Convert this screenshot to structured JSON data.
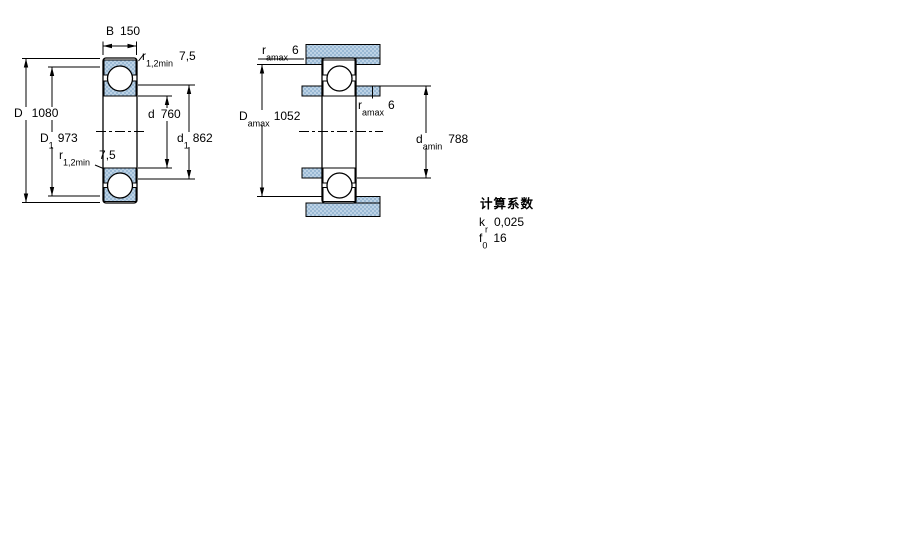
{
  "colors": {
    "hatch_light": "#bdd3e6",
    "hatch_dark": "#9ab9d4",
    "line": "#000000",
    "background": "#ffffff"
  },
  "left_drawing": {
    "width": {
      "base": "B",
      "value": "150"
    },
    "outer_diameter": {
      "base": "D",
      "value": "1080"
    },
    "outer_ring_shoulder": {
      "base": "D",
      "sub": "1",
      "value": "973"
    },
    "bore": {
      "base": "d",
      "value": "760"
    },
    "inner_ring_shoulder": {
      "base": "d",
      "sub": "1",
      "value": "862"
    },
    "fillet_top": {
      "base": "r",
      "sub": "1,2min",
      "value": "7,5"
    },
    "fillet_mid": {
      "base": "r",
      "sub": "1,2min",
      "value": "7,5"
    }
  },
  "right_drawing": {
    "housing_fillet": {
      "base": "r",
      "sub": "amax",
      "value": "6"
    },
    "housing_shoulder": {
      "base": "D",
      "sub": "amax",
      "value": "1052"
    },
    "shaft_fillet": {
      "base": "r",
      "sub": "amax",
      "value": "6"
    },
    "shaft_shoulder": {
      "base": "d",
      "sub": "amin",
      "value": "788"
    }
  },
  "calculation_factors": {
    "title": "计算系数",
    "rows": [
      {
        "base": "k",
        "sub": "r",
        "value": "0,025"
      },
      {
        "base": "f",
        "sub": "0",
        "value": "16"
      }
    ]
  }
}
